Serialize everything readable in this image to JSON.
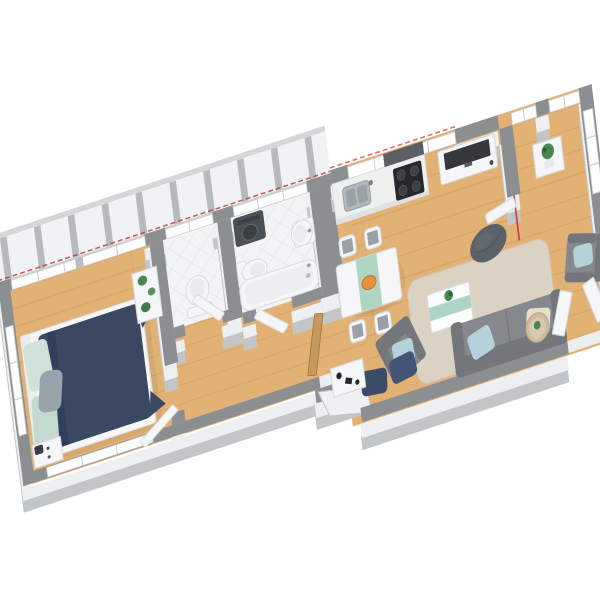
{
  "scene": {
    "type": "3d-floorplan-render",
    "view": "axonometric top-down render of an elongated one-bedroom apartment, rotated diagonally, white background, no visible text",
    "rooms": [
      {
        "name": "balcony",
        "floor": "light decking with gray slats",
        "items": []
      },
      {
        "name": "bedroom",
        "floor": "wood",
        "items": [
          "double-bed-navy-duvet",
          "mint-pillows",
          "gray-cushion",
          "white-nightstand",
          "shelf-with-plants",
          "window-wall"
        ]
      },
      {
        "name": "wc",
        "floor": "white tile",
        "items": [
          "toilet",
          "door-open-to-hallway"
        ]
      },
      {
        "name": "bathroom",
        "floor": "white tile",
        "items": [
          "dark-washing-machine",
          "toilet",
          "pedestal-sink",
          "bathtub",
          "door-open-to-hallway"
        ]
      },
      {
        "name": "hallway",
        "floor": "wood",
        "items": [
          "wooden-entrance-door",
          "entry-step"
        ]
      },
      {
        "name": "kitchen",
        "floor": "wood",
        "items": [
          "white-counter",
          "steel-sink",
          "black-cooktop",
          "dark-backsplash"
        ]
      },
      {
        "name": "dining-area",
        "floor": "wood",
        "items": [
          "white-table-mint-runner",
          "orange-bowl",
          "four-chairs"
        ]
      },
      {
        "name": "living-room",
        "floor": "wood",
        "items": [
          "tv-on-white-sideboard",
          "dark-bean-bag",
          "beige-rug",
          "coffee-table-mint-stripe-with-plant",
          "gray-sofa-blue-and-cream-pillows",
          "gray-armchair-blue-pillow",
          "two-navy-floor-cushions",
          "shoe-cabinet-with-dark-items",
          "round-side-table",
          "corner-armchair-blue-pillow",
          "open-french-doors"
        ]
      },
      {
        "name": "office-nook",
        "floor": "wood",
        "items": [
          "white-cabinet-with-plant",
          "window-bay",
          "open-door-leaf"
        ]
      }
    ],
    "annotations": [
      "thin red dashed section line running along the window wall on the upper-left side",
      "short red section mark across the office doorway near the top right"
    ]
  },
  "colors": {
    "wall_top": "#8b8f92",
    "wall_face": "#edeff0",
    "wall_rim": "#c3c6c8",
    "floor_wood": "#e2b274",
    "plank_line": "#c9945a",
    "tile": "#f3f4f5",
    "tile_line": "#dcdee0",
    "window": "#fdfdfe",
    "window_frame": "#c8cbcd",
    "balcony": "#f0f2f3",
    "balcony_slat": "#b6babc",
    "balcony_rim": "#d4d7d9",
    "rug": "#dbd2c3",
    "rug_edge": "#cec3b2",
    "sofa": "#85898d",
    "sofa_dark": "#73777b",
    "pillow_blue": "#b5d2da",
    "pillow_cream": "#e7dfc7",
    "duvet": "#3a4961",
    "duvet_fold": "#31405a",
    "pillow_mint": "#cfe2da",
    "pillow_mint2": "#c4dad1",
    "cushion_gray": "#99a3ac",
    "furniture_white": "#f5f6f7",
    "furniture_stroke": "#d7dadc",
    "counter": "#eef0f0",
    "counter_edge": "#dfe1e2",
    "steel": "#b2b8bc",
    "steel_dark": "#9aa1a5",
    "cooktop": "#26282b",
    "burner": "#3d4043",
    "backsplash": "#5c6064",
    "tv": "#34383c",
    "mint": "#aed5c3",
    "orange": "#e8913c",
    "plant": "#4a8750",
    "plant_dark": "#2e5e36",
    "pouf_navy": "#3c4b66",
    "pouf_navy2": "#445474",
    "beanbag": "#5a6167",
    "wood_door": "#c49a60",
    "red_line": "#c63b36",
    "table_beige": "#cfbc9f"
  }
}
